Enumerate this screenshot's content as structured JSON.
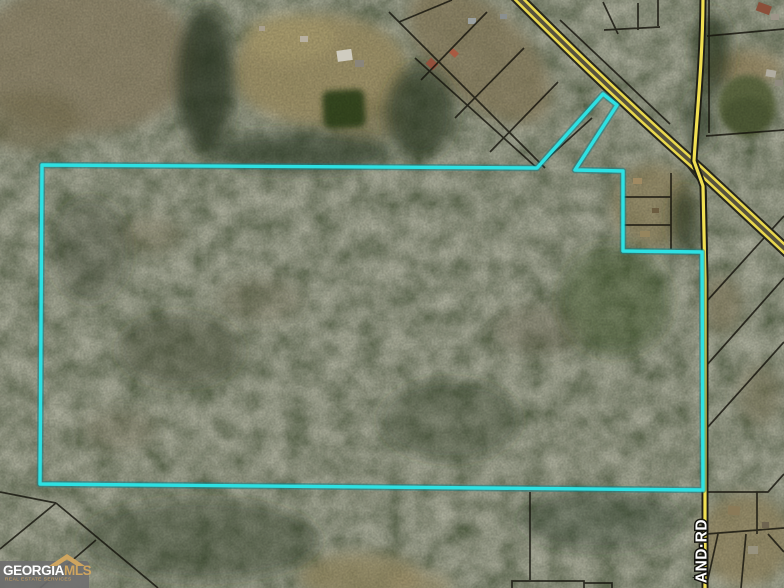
{
  "map": {
    "view": "aerial-satellite-photo",
    "road_label": "AND·RD",
    "boundary_color": "#2de1e3",
    "road_color": "#ecd94e",
    "parcel_line_color": "#15130c",
    "boundary_points": "42,165 537,168 603,94 617,105 575,170 623,171 623,251 702,252 703,490 40,484"
  },
  "watermark": {
    "brand_primary": "GEORGIA",
    "brand_secondary": "MLS",
    "tagline": "REAL ESTATE SERVICES",
    "accent_color": "#cfa55f"
  }
}
